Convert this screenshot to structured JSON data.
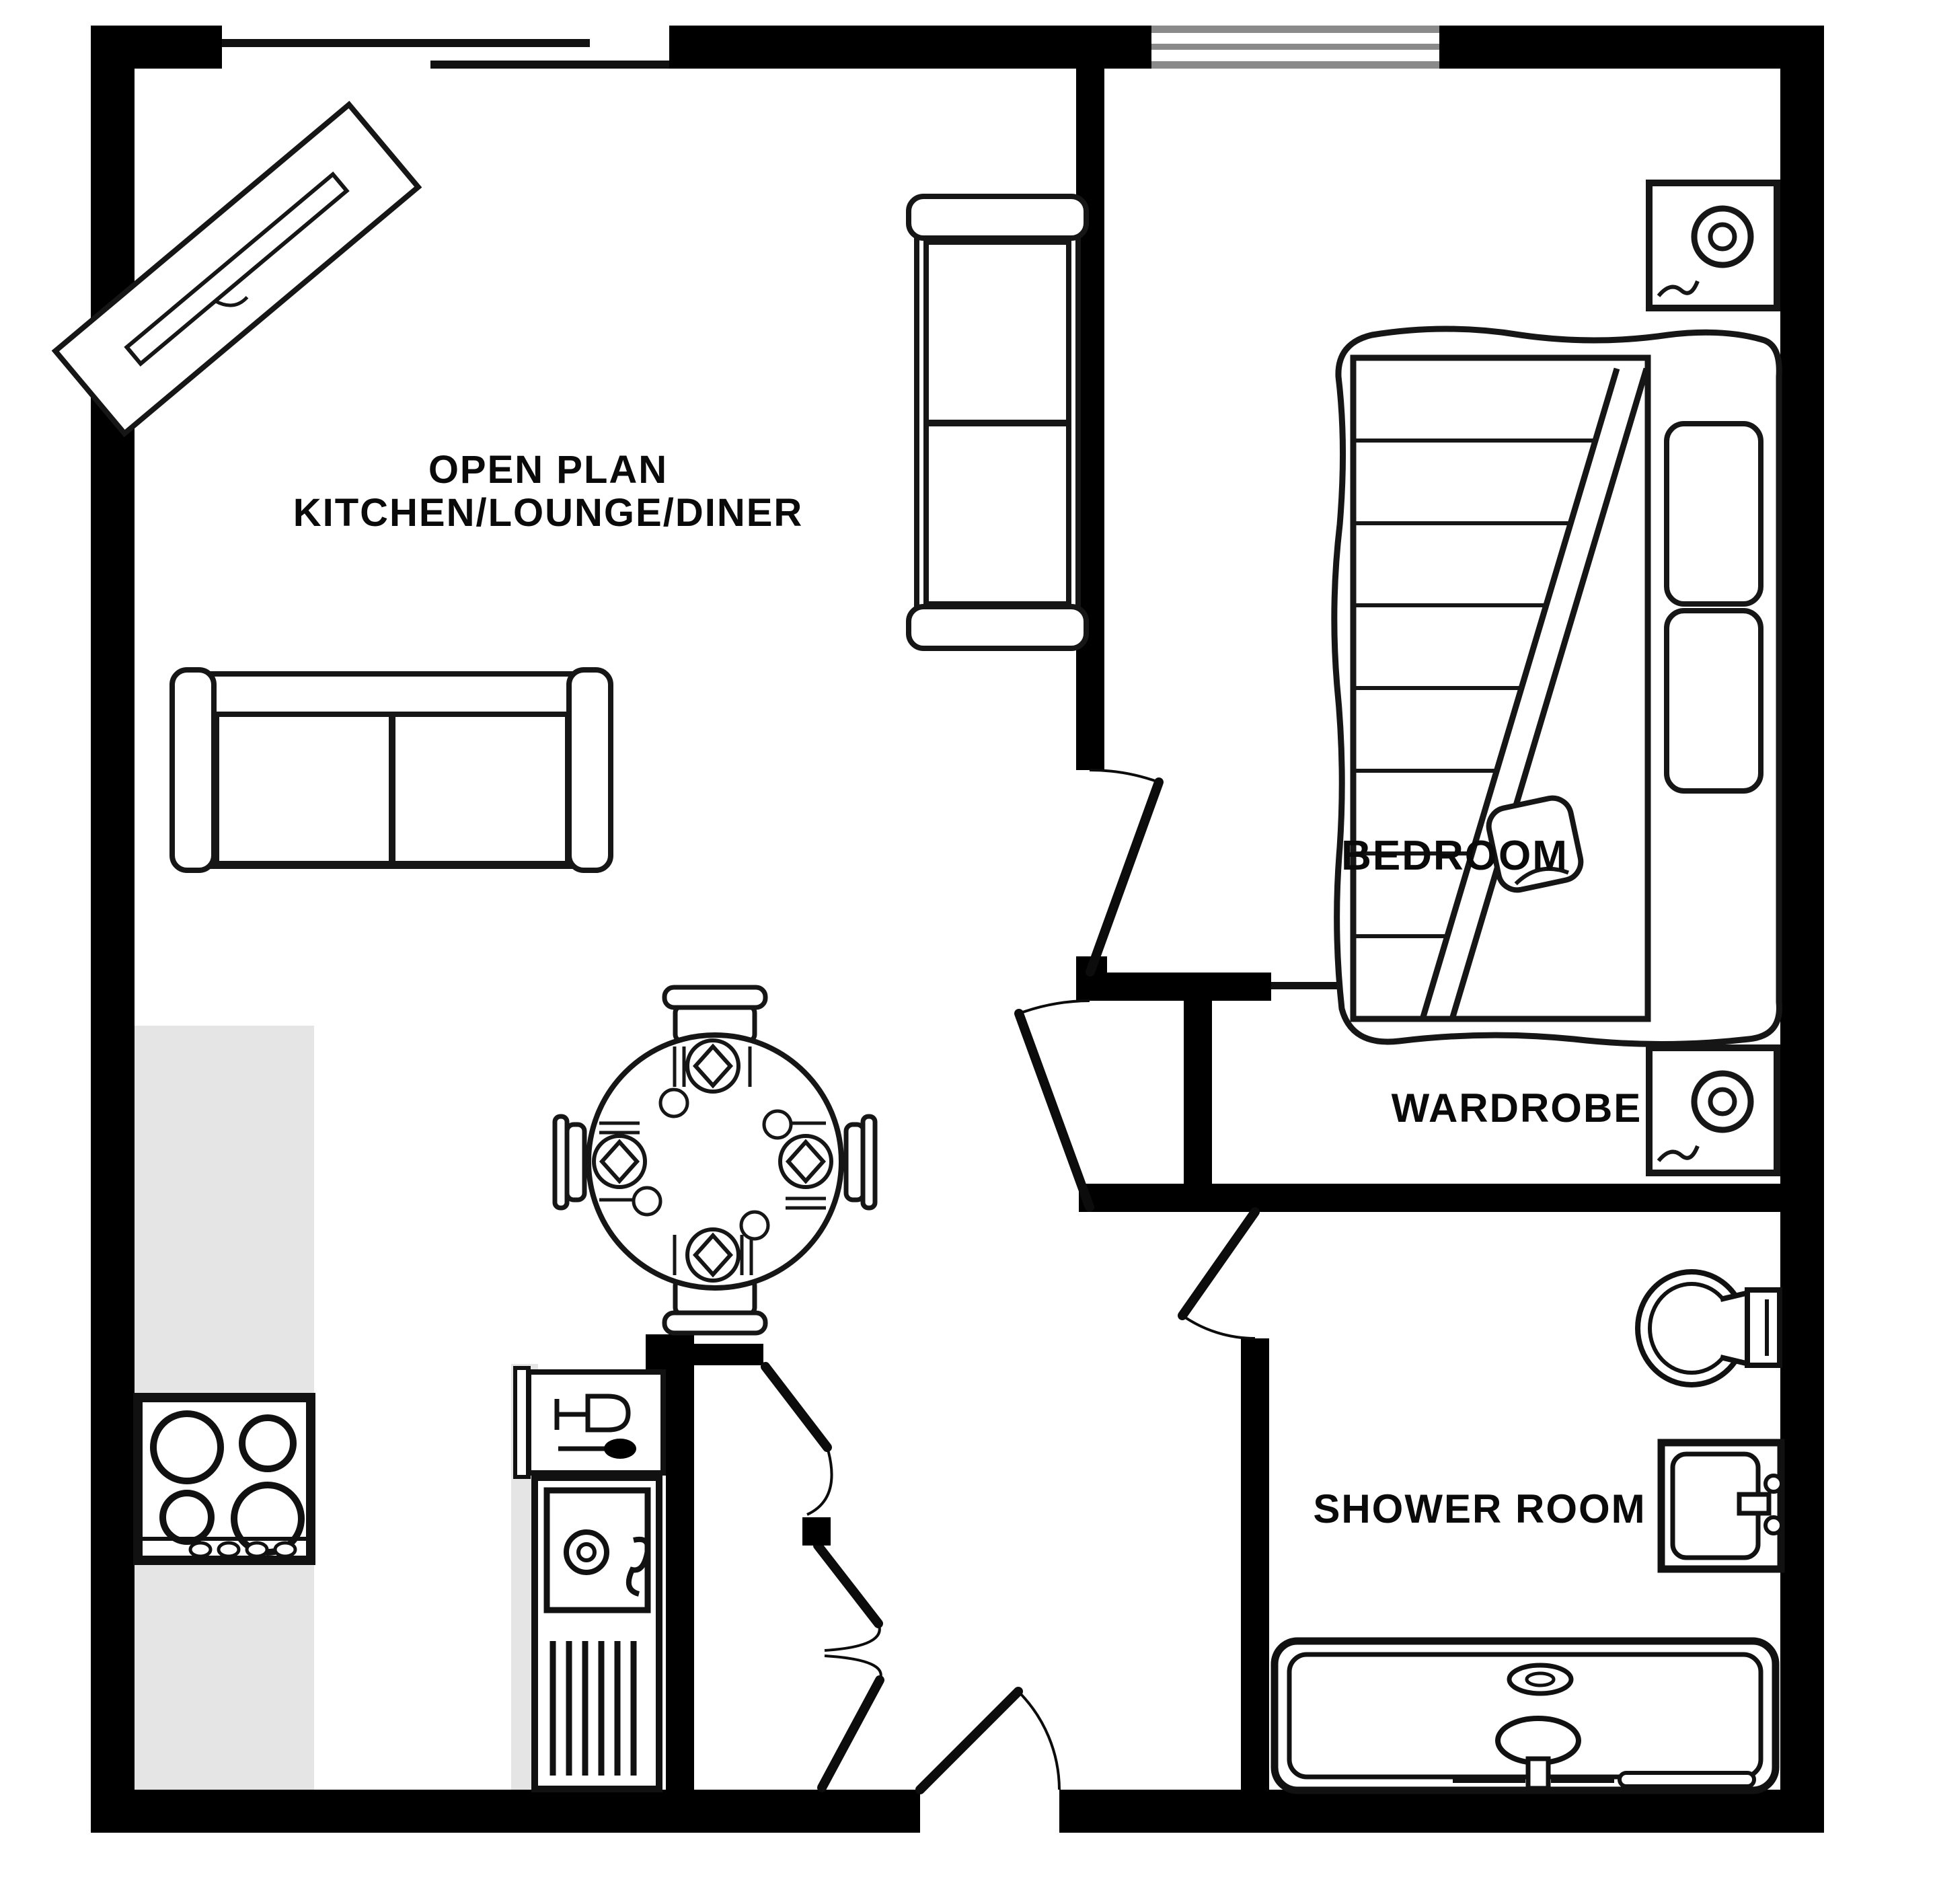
{
  "plan_title": "1 bed flat floor plan",
  "colors": {
    "walls": "#000000",
    "floor": "#ffffff",
    "worktop": "#e5e5e5",
    "window_frame": "#8a8a8a",
    "text": "#0a0a0a"
  },
  "rooms": {
    "open_plan": {
      "line1": "OPEN PLAN",
      "line2": "KITCHEN/LOUNGE/DINER"
    },
    "bedroom": {
      "label": "BEDROOM"
    },
    "wardrobe": {
      "label": "WARDROBE"
    },
    "shower": {
      "label": "SHOWER ROOM"
    }
  },
  "openings": {
    "patio_opening": "sliding-opening-top-wall",
    "window": "window-top-wall-bedroom",
    "doors": [
      "bedroom-door",
      "hall-door",
      "shower-door",
      "entrance-door",
      "closet-bifold-doors"
    ]
  },
  "furniture": {
    "living": [
      "tv-unit",
      "sofa-vertical",
      "sofa-horizontal",
      "dining-table",
      "dining-chairs-x4",
      "place-settings-x4"
    ],
    "bedroom": [
      "double-bed",
      "striped-blanket",
      "pillows-x2",
      "cushion",
      "nightstand-lamp-top",
      "nightstand-lamp-bottom"
    ],
    "kitchen": [
      "worktop",
      "hob-4-burners",
      "dishwasher-wine-glass",
      "sink-with-drainer"
    ],
    "shower_room": [
      "toilet",
      "basin-with-tap",
      "bath-with-taps"
    ],
    "storage": [
      "wardrobe-sliding-doors",
      "closet-bifold-doors"
    ]
  }
}
